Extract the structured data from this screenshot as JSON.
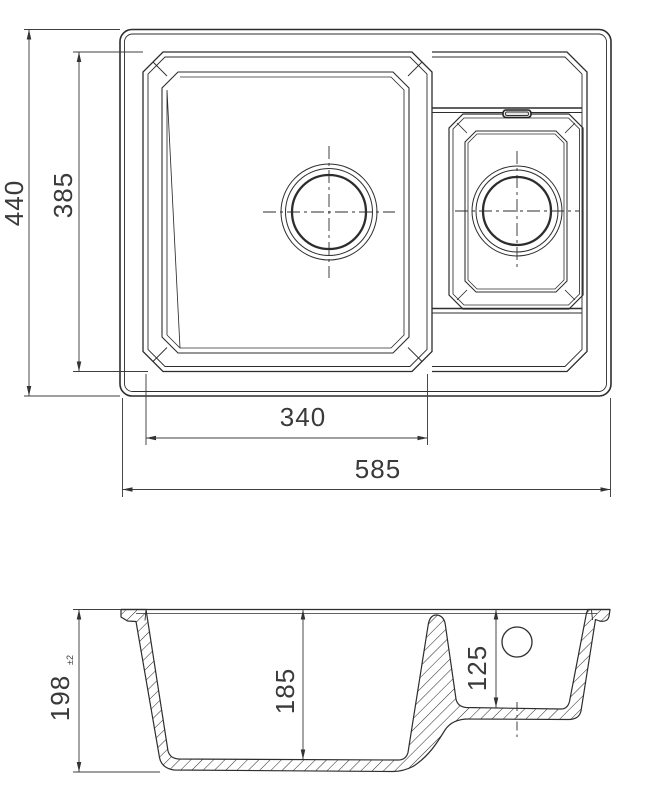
{
  "colors": {
    "line": "#2d2d2d",
    "dim_line": "#3f3f3f",
    "background": "#ffffff"
  },
  "top_view": {
    "total_height": "440",
    "bowl_opening_height": "385",
    "main_bowl_width": "340",
    "total_width": "585"
  },
  "section_view": {
    "total_depth": "198",
    "total_depth_tolerance": "±2",
    "main_bowl_depth": "185",
    "small_bowl_depth": "125"
  }
}
